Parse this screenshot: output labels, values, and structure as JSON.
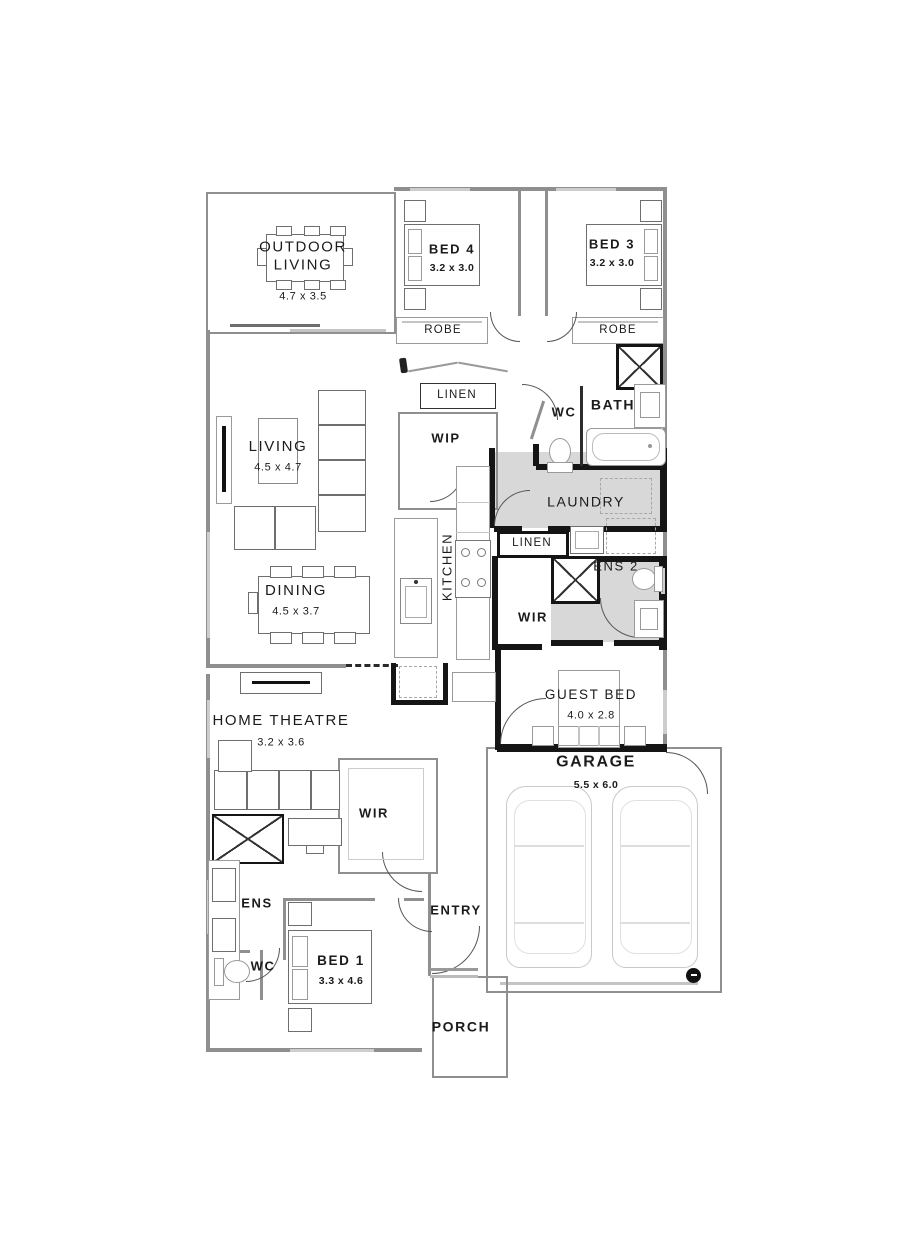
{
  "plan_title": "single-storey-house-floor-plan",
  "colors": {
    "wall_black": "#151515",
    "wall_gray": "#8f8f8f",
    "room_shade": "#d8d8d8",
    "furniture_line": "#6e6e6e",
    "label_text": "#1b1b1b"
  },
  "rooms": [
    {
      "name": "outdoor-living",
      "label": "OUTDOOR\nLIVING",
      "dims": "4.7 x 3.5"
    },
    {
      "name": "bed-4",
      "label": "BED 4",
      "dims": "3.2 x 3.0"
    },
    {
      "name": "bed-3",
      "label": "BED 3",
      "dims": "3.2 x 3.0"
    },
    {
      "name": "robe-bed-4",
      "label": "ROBE"
    },
    {
      "name": "robe-bed-3",
      "label": "ROBE"
    },
    {
      "name": "linen-hall",
      "label": "LINEN"
    },
    {
      "name": "wip-pantry",
      "label": "WIP"
    },
    {
      "name": "wc-main",
      "label": "WC"
    },
    {
      "name": "bath",
      "label": "BATH"
    },
    {
      "name": "living",
      "label": "LIVING",
      "dims": "4.5 x 4.7"
    },
    {
      "name": "kitchen",
      "label": "KITCHEN"
    },
    {
      "name": "laundry",
      "label": "LAUNDRY"
    },
    {
      "name": "linen-laundry",
      "label": "LINEN"
    },
    {
      "name": "ens-2",
      "label": "ENS 2"
    },
    {
      "name": "wir-guest",
      "label": "WIR"
    },
    {
      "name": "dining",
      "label": "DINING",
      "dims": "4.5 x 3.7"
    },
    {
      "name": "guest-bed",
      "label": "GUEST BED",
      "dims": "4.0 x 2.8"
    },
    {
      "name": "home-theatre",
      "label": "HOME THEATRE",
      "dims": "3.2 x 3.6"
    },
    {
      "name": "garage",
      "label": "GARAGE",
      "dims": "5.5 x 6.0"
    },
    {
      "name": "wir-master",
      "label": "WIR"
    },
    {
      "name": "ens-master",
      "label": "ENS"
    },
    {
      "name": "entry",
      "label": "ENTRY"
    },
    {
      "name": "wc-master",
      "label": "WC"
    },
    {
      "name": "bed-1",
      "label": "BED 1",
      "dims": "3.3 x 4.6"
    },
    {
      "name": "porch",
      "label": "PORCH"
    }
  ]
}
